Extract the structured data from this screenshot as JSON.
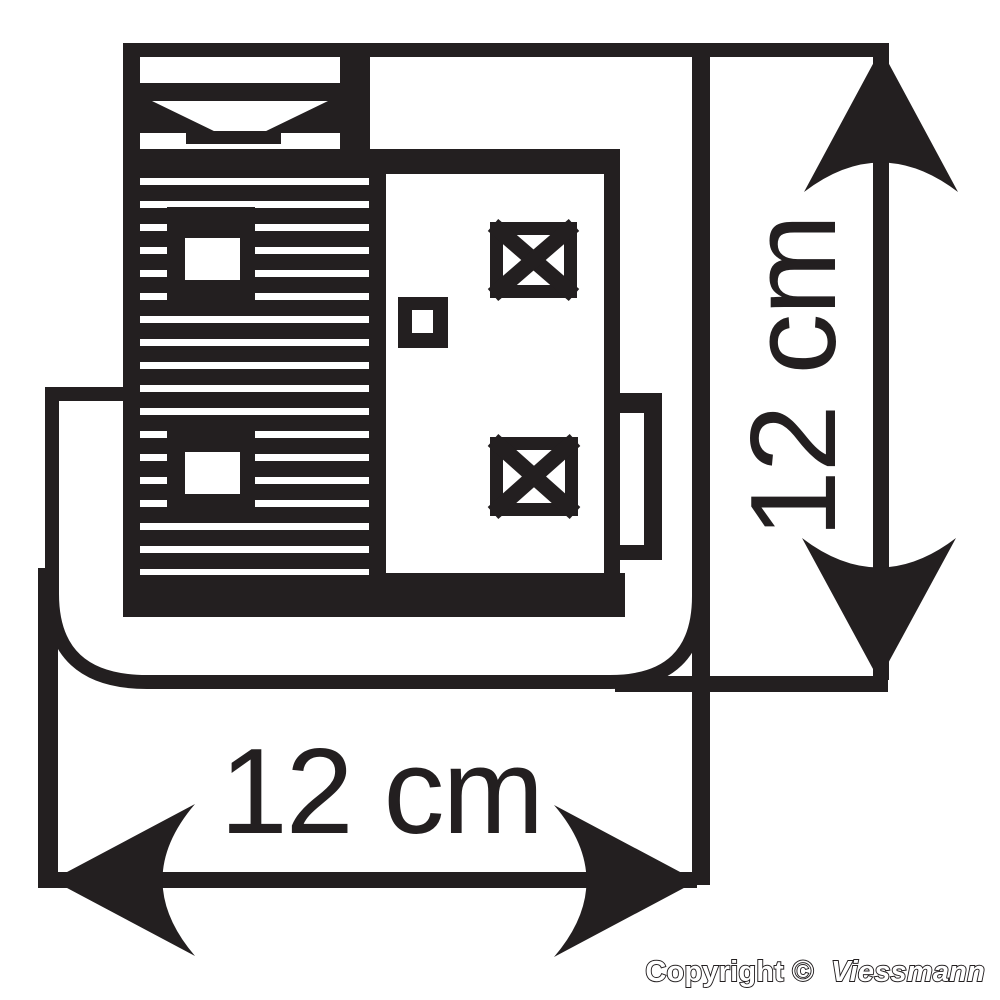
{
  "page": {
    "background_color": "#ffffff",
    "line_color": "#231f20"
  },
  "drawing": {
    "kind": "dimension-drawing",
    "width_dimension": {
      "label": "12 cm"
    },
    "height_dimension": {
      "label": "12 cm"
    },
    "copyright": {
      "prefix": "Copyright ©",
      "brand": "Viessmann"
    }
  }
}
